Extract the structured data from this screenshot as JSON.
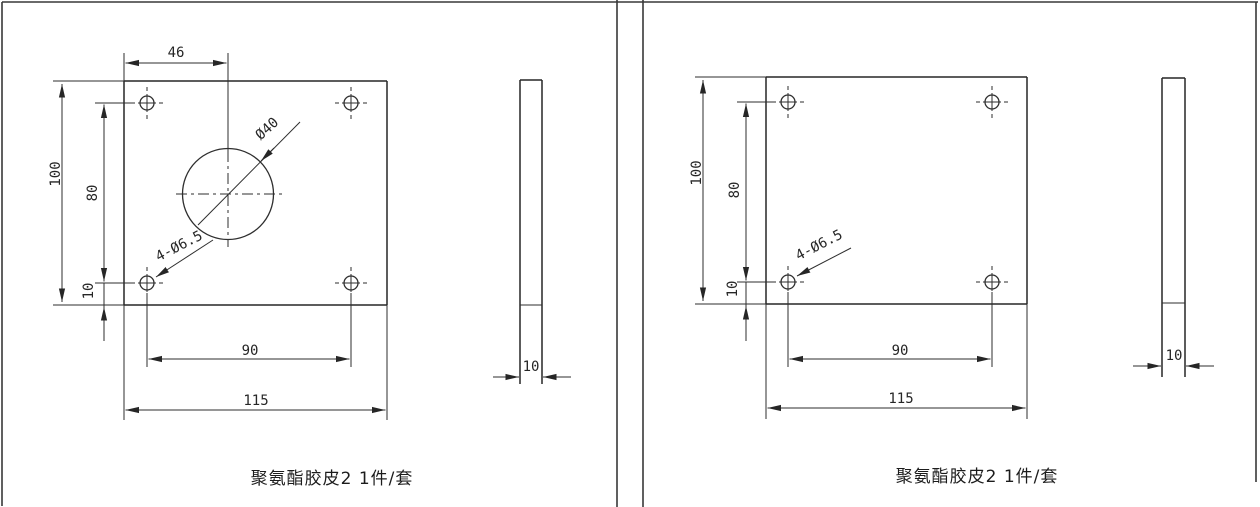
{
  "colors": {
    "ink": "#2e2e2e",
    "background": "#ffffff"
  },
  "panels": [
    {
      "caption": "聚氨酯胶皮2 1件/套",
      "labels": {
        "offset_x": "46",
        "height": "100",
        "hole_span_v": "80",
        "edge_offset": "10",
        "hole_span_h": "90",
        "width": "115",
        "thickness": "10",
        "center_hole": "Ø40",
        "corner_holes": "4-Ø6.5"
      }
    },
    {
      "caption": "聚氨酯胶皮2 1件/套",
      "labels": {
        "height": "100",
        "hole_span_v": "80",
        "edge_offset": "10",
        "hole_span_h": "90",
        "width": "115",
        "thickness": "10",
        "corner_holes": "4-Ø6.5"
      }
    }
  ]
}
